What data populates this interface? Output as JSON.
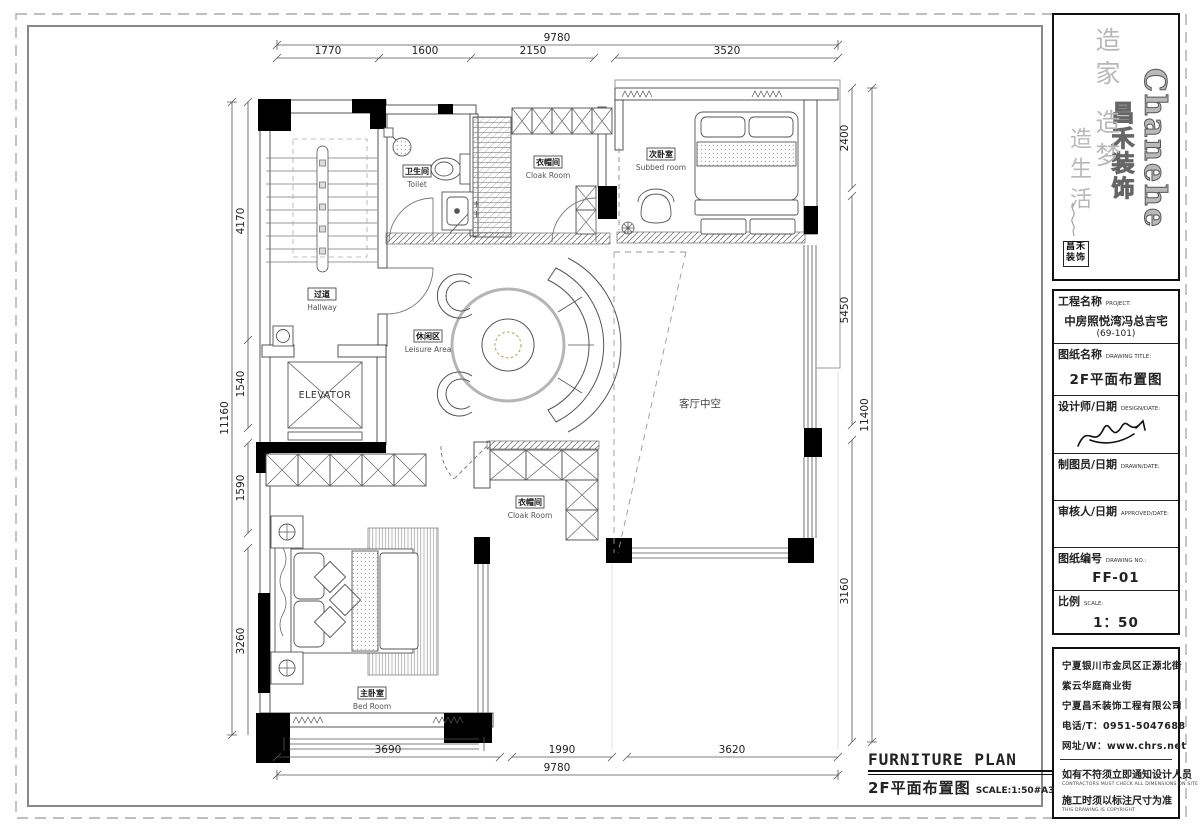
{
  "plan_title": {
    "en": "FURNITURE PLAN",
    "cn": "2F平面布置图",
    "scale": "SCALE:1:50#A3"
  },
  "logo": {
    "brand_en": "Chanehe",
    "brand_cn": "昌禾装饰",
    "slogan_a": "造家 造梦",
    "slogan_b": "造生活",
    "seal": "昌禾装饰"
  },
  "titleblock": {
    "project_label": "工程名称",
    "project_label_en": "PROJECT:",
    "project_name": "中房照悦湾冯总吉宅",
    "project_unit": "(69-101)",
    "drawing_title_label": "图纸名称",
    "drawing_title_label_en": "DRAWING TITLE:",
    "drawing_title": "2F平面布置图",
    "designer_label": "设计师/日期",
    "designer_label_en": "DESIGN/DATE:",
    "drafter_label": "制图员/日期",
    "drafter_label_en": "DRAWN/DATE:",
    "approver_label": "审核人/日期",
    "approver_label_en": "APPROVED/DATE:",
    "drawing_no_label": "图纸编号",
    "drawing_no_label_en": "DRAWING NO.:",
    "drawing_no": "FF-01",
    "scale_label": "比例",
    "scale_label_en": "SCALE:",
    "scale_value": "1：50"
  },
  "company": {
    "address1": "宁夏银川市金凤区正源北街",
    "address2": "紫云华庭商业街",
    "name": "宁夏昌禾装饰工程有限公司",
    "phone": "电话/T：0951-5047688",
    "web": "网址/W：www.chrs.net",
    "note1_cn": "如有不符须立即通知设计人员",
    "note1_en": "CONTRACTORS MUST CHECK ALL DIMENSIONS ON SITE",
    "note2_cn": "施工时须以标注尺寸为准",
    "note2_en": "THIS DRAWING IS COPYRIGHT"
  },
  "rooms": {
    "toilet": {
      "cn": "卫生间",
      "en": "Toilet"
    },
    "cloak_top": {
      "cn": "衣帽间",
      "en": "Cloak Room"
    },
    "subbed": {
      "cn": "次卧室",
      "en": "Subbed room"
    },
    "hallway": {
      "cn": "过道",
      "en": "Hallway"
    },
    "elevator": "ELEVATOR",
    "leisure": {
      "cn": "休闲区",
      "en": "Leisure Area"
    },
    "void": "客厅中空",
    "cloak_bottom": {
      "cn": "衣帽间",
      "en": "Cloak Room"
    },
    "bedroom": {
      "cn": "主卧室",
      "en": "Bed Room"
    }
  },
  "dims": {
    "top_overall": "9780",
    "top": [
      "1770",
      "1600",
      "2150",
      "3520"
    ],
    "left_overall": "11160",
    "left": [
      "4170",
      "1540",
      "1590",
      "3260"
    ],
    "right_overall": "11400",
    "right": [
      "2400",
      "5450",
      "3160"
    ],
    "bottom_overall": "9780",
    "bottom": [
      "3690",
      "1990",
      "3620"
    ]
  }
}
